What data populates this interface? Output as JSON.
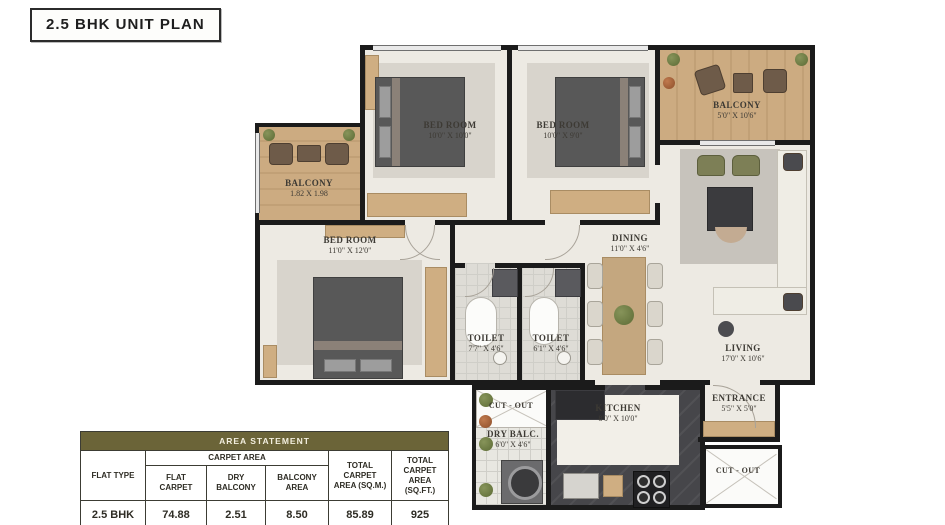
{
  "title": "2.5 BHK UNIT PLAN",
  "colors": {
    "wall": "#1b1b1b",
    "floor": "#edeae3",
    "wood": "#ccab81",
    "granite": "#46464a",
    "table_header": "#6b6438"
  },
  "rooms": {
    "bedroom1": {
      "name": "BED ROOM",
      "dim": "10'0\" X 10'0\""
    },
    "bedroom2": {
      "name": "BED ROOM",
      "dim": "10'0\" X 9'0\""
    },
    "bedroom3": {
      "name": "BED ROOM",
      "dim": "11'0\" X 12'0\""
    },
    "balcony_top": {
      "name": "BALCONY",
      "dim": "5'0\" X 10'6\""
    },
    "balcony_left": {
      "name": "BALCONY",
      "dim": "1.82 X 1.98"
    },
    "living": {
      "name": "LIVING",
      "dim": "17'0\" X 10'6\""
    },
    "dining": {
      "name": "DINING",
      "dim": "11'0\" X 4'6\""
    },
    "toilet1": {
      "name": "TOILET",
      "dim": "7'7\" X 4'6\""
    },
    "toilet2": {
      "name": "TOILET",
      "dim": "6'1\" X 4'6\""
    },
    "kitchen": {
      "name": "KITCHEN",
      "dim": "8'0\" X 10'0\""
    },
    "dry_balcony": {
      "name": "DRY BALC.",
      "dim": "6'0\" X 4'6\""
    },
    "entrance": {
      "name": "ENTRANCE",
      "dim": "5'5\" X 5'0\""
    },
    "cutout": {
      "name": "CUT - OUT"
    }
  },
  "area_table": {
    "header": "AREA STATEMENT",
    "col_flat_type": "FLAT TYPE",
    "col_carpet_area": "CARPET AREA",
    "col_flat_carpet": "FLAT CARPET",
    "col_dry_balcony": "DRY BALCONY",
    "col_balcony_area": "BALCONY AREA",
    "col_total_sqm": "TOTAL CARPET AREA (SQ.M.)",
    "col_total_sqft": "TOTAL CARPET AREA (SQ.FT.)",
    "row": {
      "flat_type": "2.5 BHK",
      "flat_carpet": "74.88",
      "dry_balcony": "2.51",
      "balcony_area": "8.50",
      "total_sqm": "85.89",
      "total_sqft": "925"
    }
  }
}
